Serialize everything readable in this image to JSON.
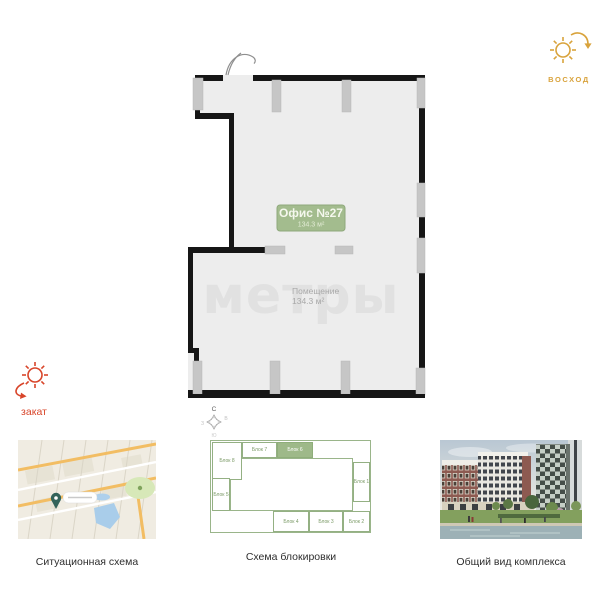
{
  "plan": {
    "office_label": "Офис №27",
    "office_area": "134.3 м²",
    "room_name": "Помещение",
    "room_area": "134.3 м²",
    "watermark": "метры",
    "colors": {
      "wall": "#161616",
      "interior": "#ededed",
      "column": "#c6c6c6",
      "label_bg": "#a3bc8e",
      "label_text": "#f5f8ee"
    }
  },
  "orientation": {
    "sunrise_label": "ВОСХОД",
    "sunrise_color": "#d9a33c",
    "sunset_label": "закат",
    "sunset_color": "#d8452a",
    "compass": {
      "north": "С",
      "east": "В",
      "south": "Ю",
      "west": "З"
    }
  },
  "thumbnails": {
    "map_caption": "Ситуационная схема",
    "scheme_caption": "Схема блокировки",
    "render_caption": "Общий вид комплекса"
  },
  "block_scheme": {
    "accent_color": "#8fae7a",
    "selected_block": "Блок 6",
    "blocks": [
      {
        "label": "Блок 8",
        "x": 2,
        "y": 2,
        "w": 30,
        "h": 38,
        "selected": false
      },
      {
        "label": "Блок 7",
        "x": 32,
        "y": 2,
        "w": 35,
        "h": 16,
        "selected": false
      },
      {
        "label": "Блок 6",
        "x": 67,
        "y": 2,
        "w": 36,
        "h": 16,
        "selected": true
      },
      {
        "label": "Блок 1",
        "x": 143,
        "y": 22,
        "w": 17,
        "h": 40,
        "selected": false
      },
      {
        "label": "Блок 2",
        "x": 133,
        "y": 71,
        "w": 27,
        "h": 21,
        "selected": false
      },
      {
        "label": "Блок 3",
        "x": 99,
        "y": 71,
        "w": 34,
        "h": 21,
        "selected": false
      },
      {
        "label": "Блок 4",
        "x": 63,
        "y": 71,
        "w": 36,
        "h": 21,
        "selected": false
      },
      {
        "label": "Блок 5",
        "x": 2,
        "y": 38,
        "w": 18,
        "h": 33,
        "selected": false
      }
    ]
  }
}
